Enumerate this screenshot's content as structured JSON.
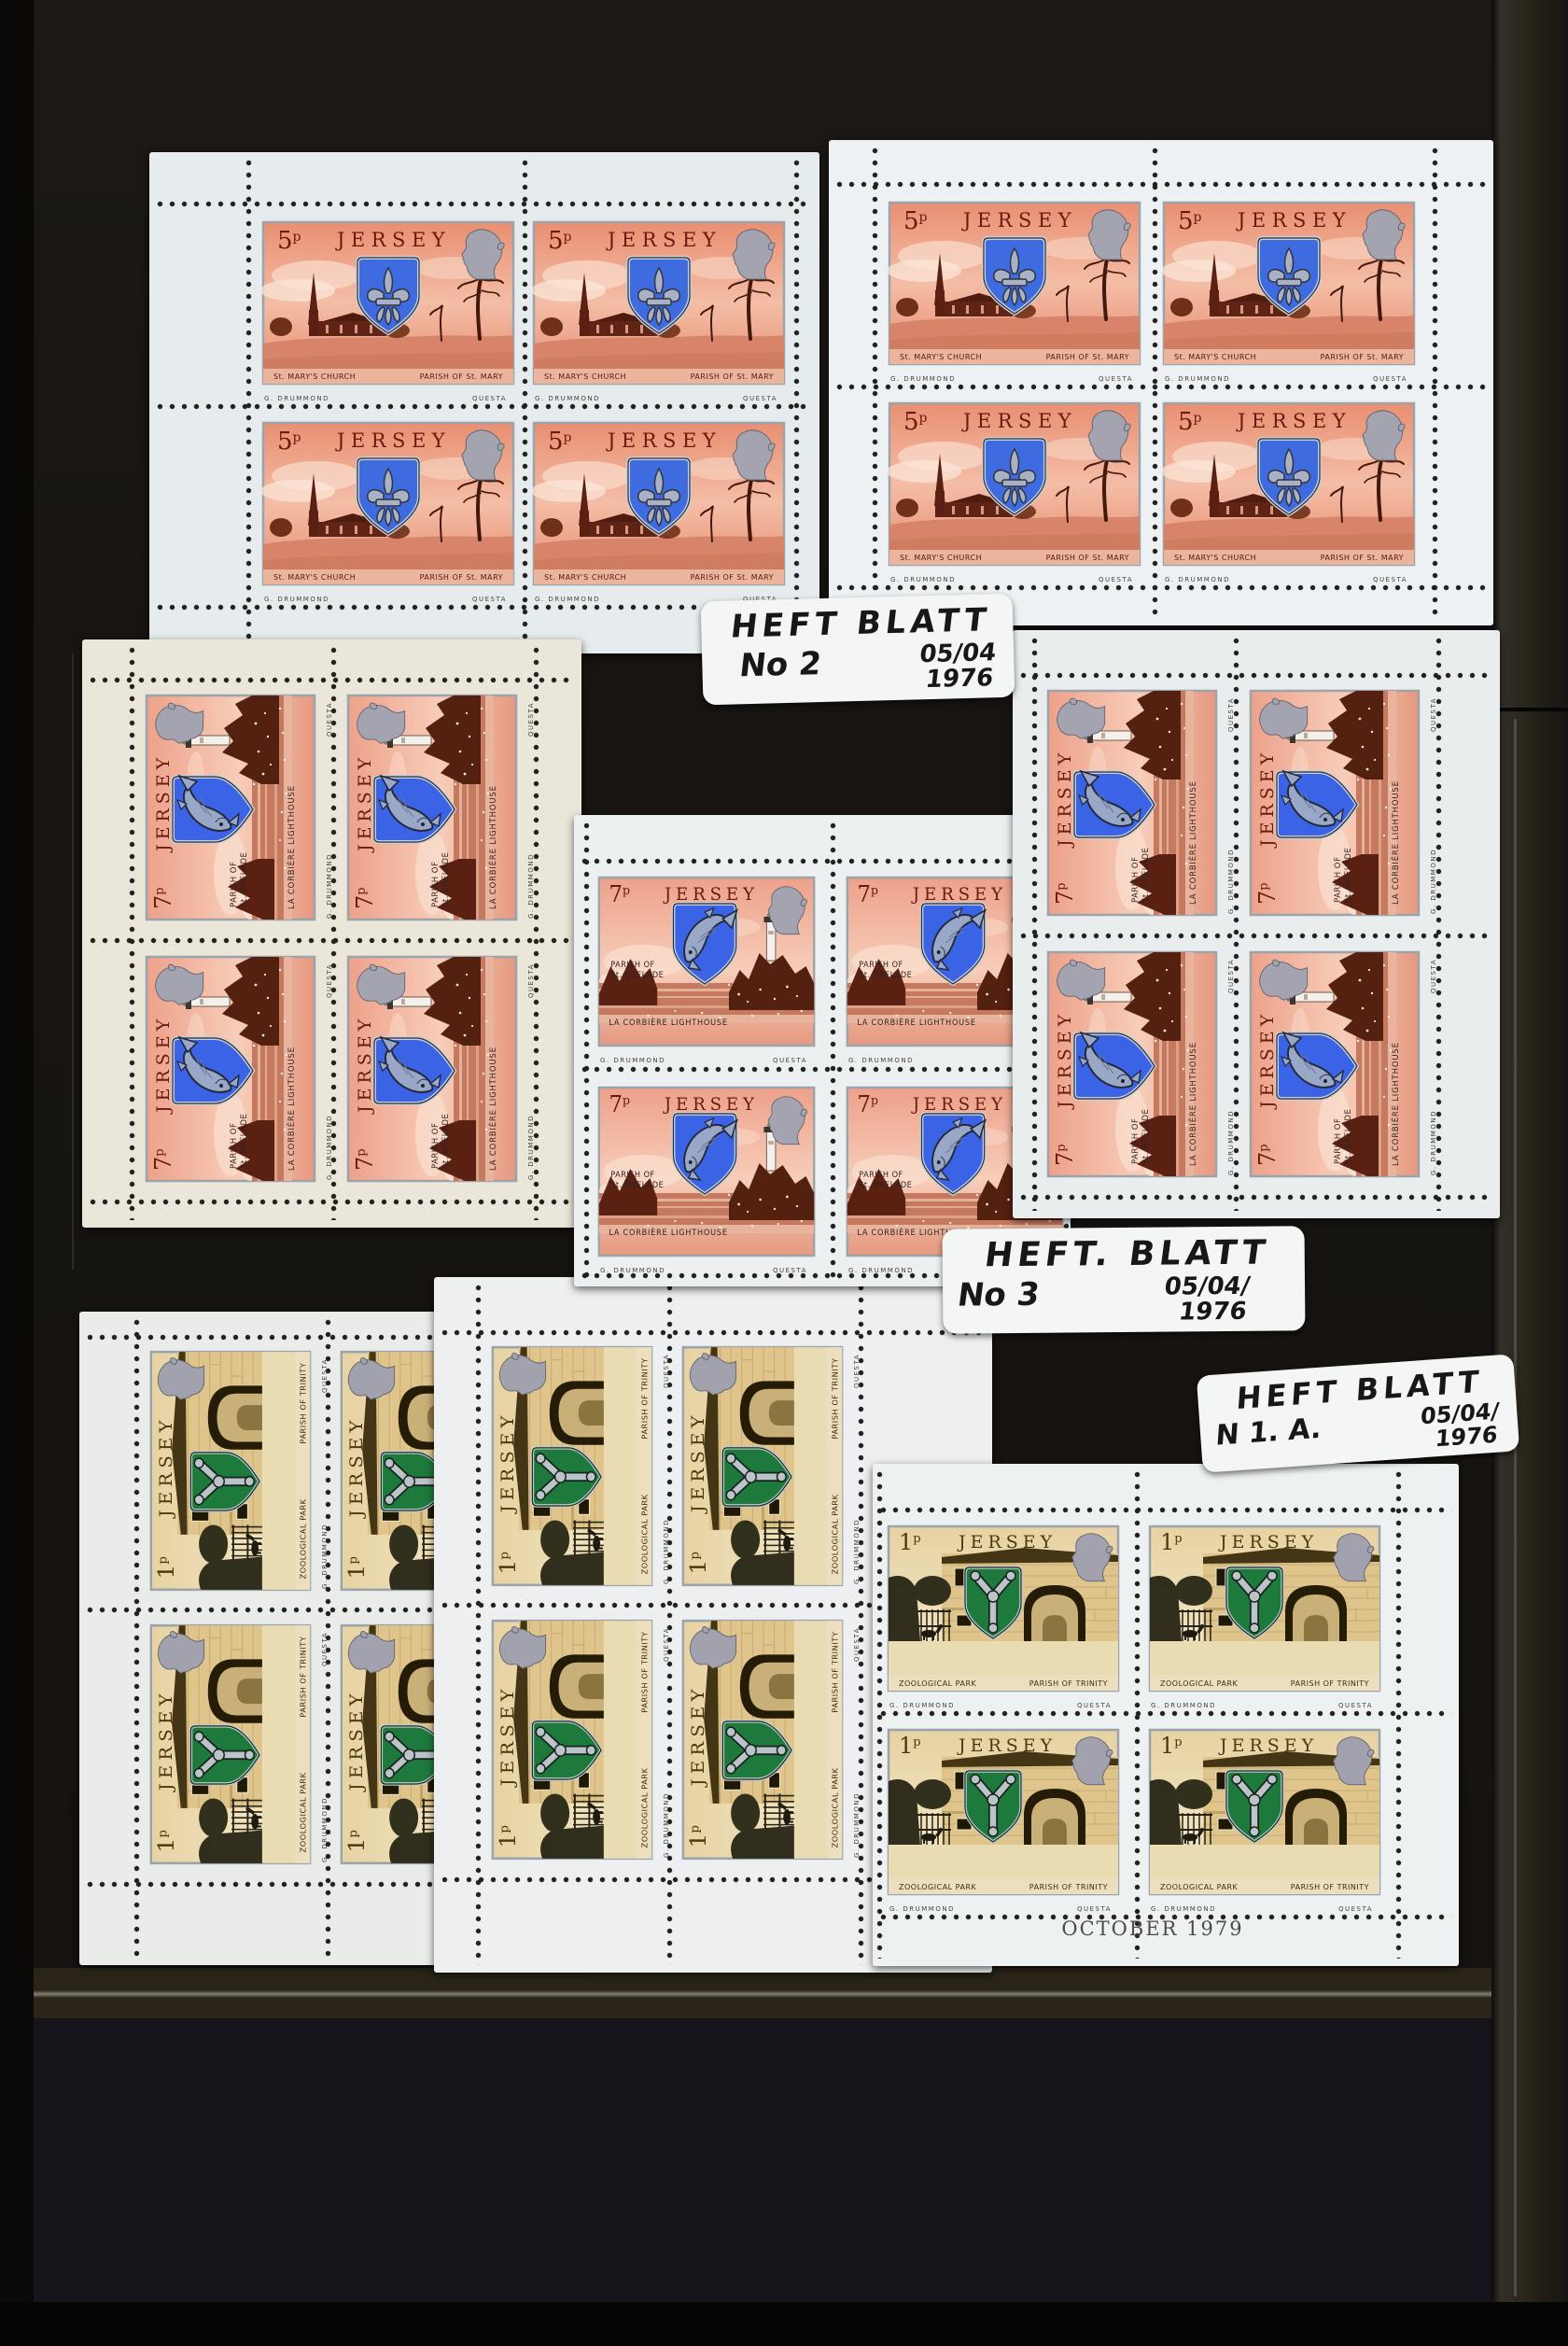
{
  "page": {
    "description": "Black stockbook page with Jersey stamp booklet panes",
    "background_color": "#171411",
    "pocket_strip_color": "#2a2518"
  },
  "stamp_designs": {
    "five_p": {
      "denomination": "5",
      "denomination_unit": "p",
      "country": "JERSEY",
      "caption_left": "St. MARY'S CHURCH",
      "caption_right": "PARISH OF St. MARY",
      "designer_credit": "G. DRUMMOND",
      "printer_credit": "QUESTA",
      "colors": {
        "sky": "#ec9379",
        "scene": "#5a2113",
        "shield_blue": "#3e6ce0",
        "emblem_silver": "#a9b1c6",
        "title": "#6b1a0e"
      }
    },
    "seven_p": {
      "denomination": "7",
      "denomination_unit": "p",
      "country": "JERSEY",
      "side_caption_line1": "PARISH OF",
      "side_caption_line2": "St. BRELADE",
      "caption": "LA CORBIÈRE LIGHTHOUSE",
      "designer_credit": "G. DRUMMOND",
      "printer_credit": "QUESTA",
      "colors": {
        "sky": "#eda189",
        "rocks": "#57200f",
        "shield_blue": "#3b63e6",
        "fish_silver": "#9aa8c8",
        "title": "#6b1a0e"
      }
    },
    "one_p": {
      "denomination": "1",
      "denomination_unit": "p",
      "country": "JERSEY",
      "caption_left": "ZOOLOGICAL PARK",
      "caption_right": "PARISH OF TRINITY",
      "designer_credit": "G. DRUMMOND",
      "printer_credit": "QUESTA",
      "colors": {
        "sky": "#ecd8ab",
        "wall": "#dfc58c",
        "shield_green": "#1e7a3c",
        "emblem_silver": "#bcc3c9",
        "title": "#4a3a10"
      }
    }
  },
  "sheetlets": [
    {
      "id": "5p-upper-left",
      "design": "five_p",
      "layout": "2x2",
      "orientation": "upright"
    },
    {
      "id": "5p-upper-right",
      "design": "five_p",
      "layout": "2x2",
      "orientation": "upright"
    },
    {
      "id": "7p-middle-left",
      "design": "seven_p",
      "layout": "2x2",
      "orientation": "rotated-90"
    },
    {
      "id": "7p-middle-centre",
      "design": "seven_p",
      "layout": "2x2",
      "orientation": "upright"
    },
    {
      "id": "7p-middle-right",
      "design": "seven_p",
      "layout": "2x2",
      "orientation": "rotated-90"
    },
    {
      "id": "1p-lower-left",
      "design": "one_p",
      "layout": "2x2",
      "orientation": "rotated-90"
    },
    {
      "id": "1p-lower-middle",
      "design": "one_p",
      "layout": "2x2",
      "orientation": "rotated-90"
    },
    {
      "id": "1p-lower-right",
      "design": "one_p",
      "layout": "2x2",
      "orientation": "upright",
      "margin_imprint": "OCTOBER 1979"
    }
  ],
  "imprint": {
    "text": "OCTOBER 1979"
  },
  "handwritten_labels": [
    {
      "line1": "HEFT BLATT",
      "number": "No 2",
      "date": "05/04",
      "year": "1976"
    },
    {
      "line1": "HEFT. BLATT",
      "number": "No 3",
      "date": "05/04/",
      "year": "1976"
    },
    {
      "line1": "HEFT BLATT",
      "number": "N 1. A.",
      "date": "05/04/",
      "year": "1976"
    }
  ]
}
